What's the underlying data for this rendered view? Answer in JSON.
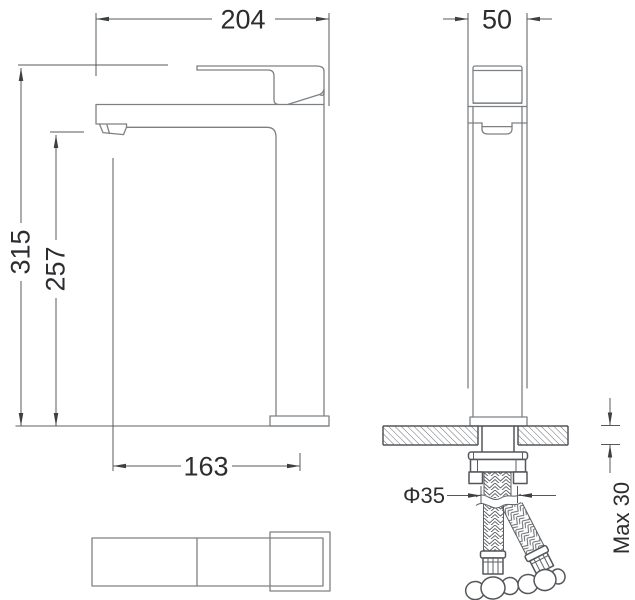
{
  "drawing": {
    "background": "#ffffff",
    "outline_color": "#7d8083",
    "dimension_line_color": "#56595c",
    "text_color": "#2c2d2f",
    "hardware_line_color": "#53565a",
    "dimensions": {
      "overall_length_mm": "204",
      "total_height_mm": "315",
      "spout_outlet_height_mm": "257",
      "spout_reach_mm": "163",
      "body_width_mm": "50",
      "mounting_hole_diameter": "Φ35",
      "max_mounting_thickness": "Max 30"
    }
  }
}
